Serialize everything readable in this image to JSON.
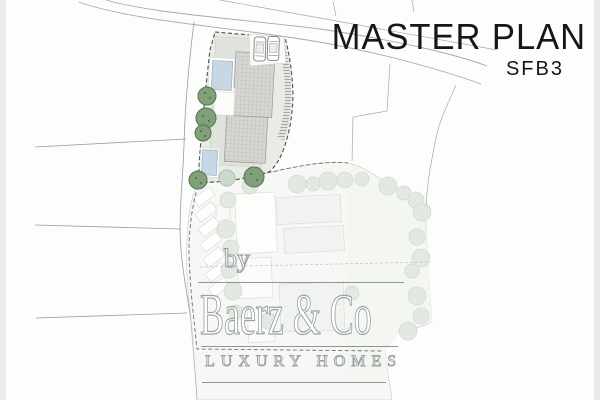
{
  "header": {
    "title": "MASTER PLAN",
    "subtitle": "SFB3"
  },
  "watermark": {
    "prefix": "by",
    "brand": "Baerz & Co",
    "tagline": "LUXURY HOMES"
  },
  "plan": {
    "colors": {
      "road_line": "#a8a8a8",
      "terrain_line": "#999999",
      "parcel_boundary_dash": "#555555",
      "upper_parcel_fill": "#e9ebe6",
      "lower_parcel_fill": "#f4f6f2",
      "garden_tint": "#eef2ea",
      "building_roof": "#d6d6d2",
      "faded_roof": "#ecefeb",
      "pool_water": "#c7d7e3",
      "tree_dark": "#7fa078",
      "tree_faded": "#d3decf",
      "title_text": "#161616",
      "watermark_outline": "#9aa3a1"
    }
  }
}
